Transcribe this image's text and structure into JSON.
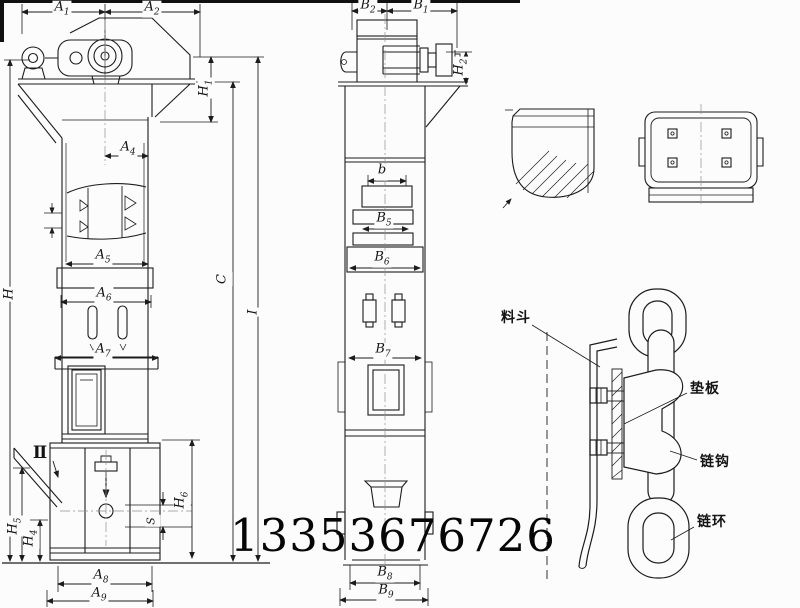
{
  "colors": {
    "background": "#fcfcfc",
    "ink": "#1c1c1c"
  },
  "phone_number": "13353676726",
  "dims": {
    "A1": {
      "letter": "A",
      "sub": "1"
    },
    "A2": {
      "letter": "A",
      "sub": "2"
    },
    "A4": {
      "letter": "A",
      "sub": "4"
    },
    "A5": {
      "letter": "A",
      "sub": "5"
    },
    "A6": {
      "letter": "A",
      "sub": "6"
    },
    "A7": {
      "letter": "A",
      "sub": "7"
    },
    "A8": {
      "letter": "A",
      "sub": "8"
    },
    "A9": {
      "letter": "A",
      "sub": "9"
    },
    "B1": {
      "letter": "B",
      "sub": "1"
    },
    "B2": {
      "letter": "B",
      "sub": "2"
    },
    "B5": {
      "letter": "B",
      "sub": "5"
    },
    "B6": {
      "letter": "B",
      "sub": "6"
    },
    "B7": {
      "letter": "B",
      "sub": "7"
    },
    "B8": {
      "letter": "B",
      "sub": "8"
    },
    "B9": {
      "letter": "B",
      "sub": "9"
    },
    "H": {
      "letter": "H",
      "sub": ""
    },
    "H1": {
      "letter": "H",
      "sub": "1"
    },
    "H2": {
      "letter": "H",
      "sub": "2"
    },
    "H4": {
      "letter": "H",
      "sub": "4"
    },
    "H5": {
      "letter": "H",
      "sub": "5"
    },
    "H6": {
      "letter": "H",
      "sub": "6"
    },
    "C": {
      "letter": "C",
      "sub": ""
    },
    "I": {
      "letter": "I",
      "sub": ""
    },
    "S": {
      "letter": "S",
      "sub": ""
    },
    "b": {
      "letter": "b",
      "sub": ""
    },
    "II": {
      "letter": "Ⅱ",
      "sub": ""
    }
  },
  "detail_labels": {
    "hopper": "料斗",
    "pad_plate": "垫板",
    "chain_hook": "链钩",
    "chain_ring": "链环"
  }
}
